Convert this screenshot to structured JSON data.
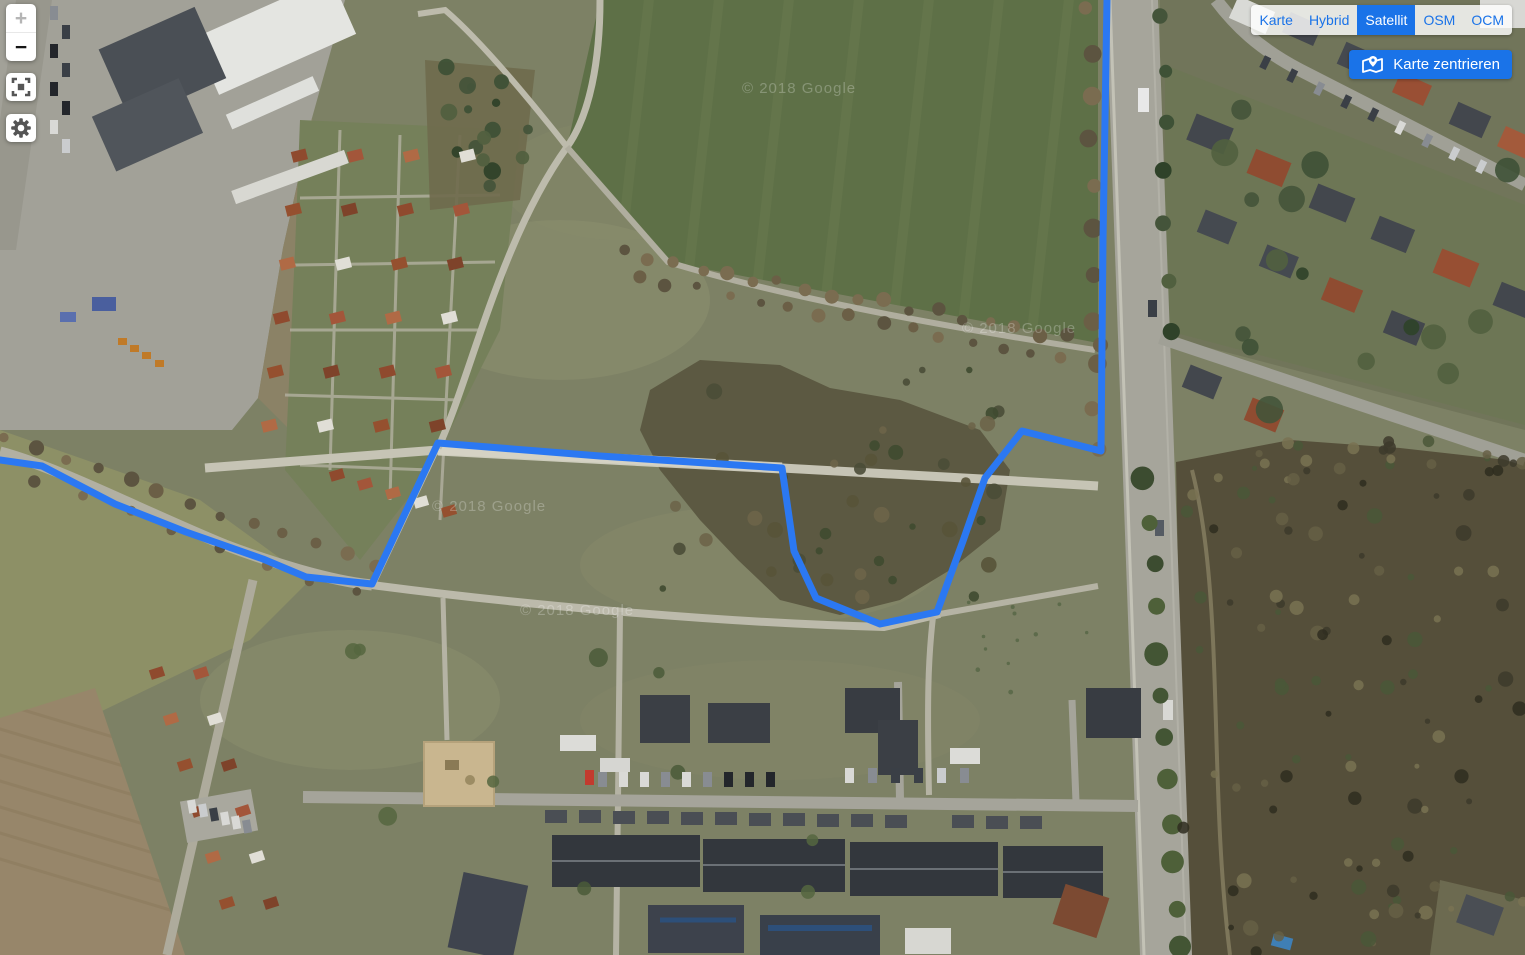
{
  "map": {
    "watermark": "© 2018 Google",
    "track": {
      "color": "#2b78f2",
      "width": 7,
      "points": [
        [
          0,
          460
        ],
        [
          42,
          466
        ],
        [
          115,
          504
        ],
        [
          186,
          532
        ],
        [
          263,
          559
        ],
        [
          306,
          577
        ],
        [
          372,
          584
        ],
        [
          438,
          443
        ],
        [
          600,
          456
        ],
        [
          782,
          468
        ],
        [
          794,
          551
        ],
        [
          816,
          598
        ],
        [
          880,
          624
        ],
        [
          937,
          612
        ],
        [
          963,
          541
        ],
        [
          985,
          478
        ],
        [
          1022,
          431
        ],
        [
          1101,
          451
        ],
        [
          1103,
          240
        ],
        [
          1107,
          0
        ]
      ]
    }
  },
  "controls": {
    "zoom_in": "+",
    "zoom_out": "−",
    "layers": [
      {
        "label": "Karte",
        "active": false
      },
      {
        "label": "Hybrid",
        "active": false
      },
      {
        "label": "Satellit",
        "active": true
      },
      {
        "label": "OSM",
        "active": false
      },
      {
        "label": "OCM",
        "active": false
      }
    ],
    "center_button": "Karte zentrieren",
    "accent_color": "#1a73e8",
    "icons": [
      "plus-icon",
      "minus-icon",
      "fit-track-icon",
      "gear-icon",
      "map-pin-icon"
    ]
  }
}
